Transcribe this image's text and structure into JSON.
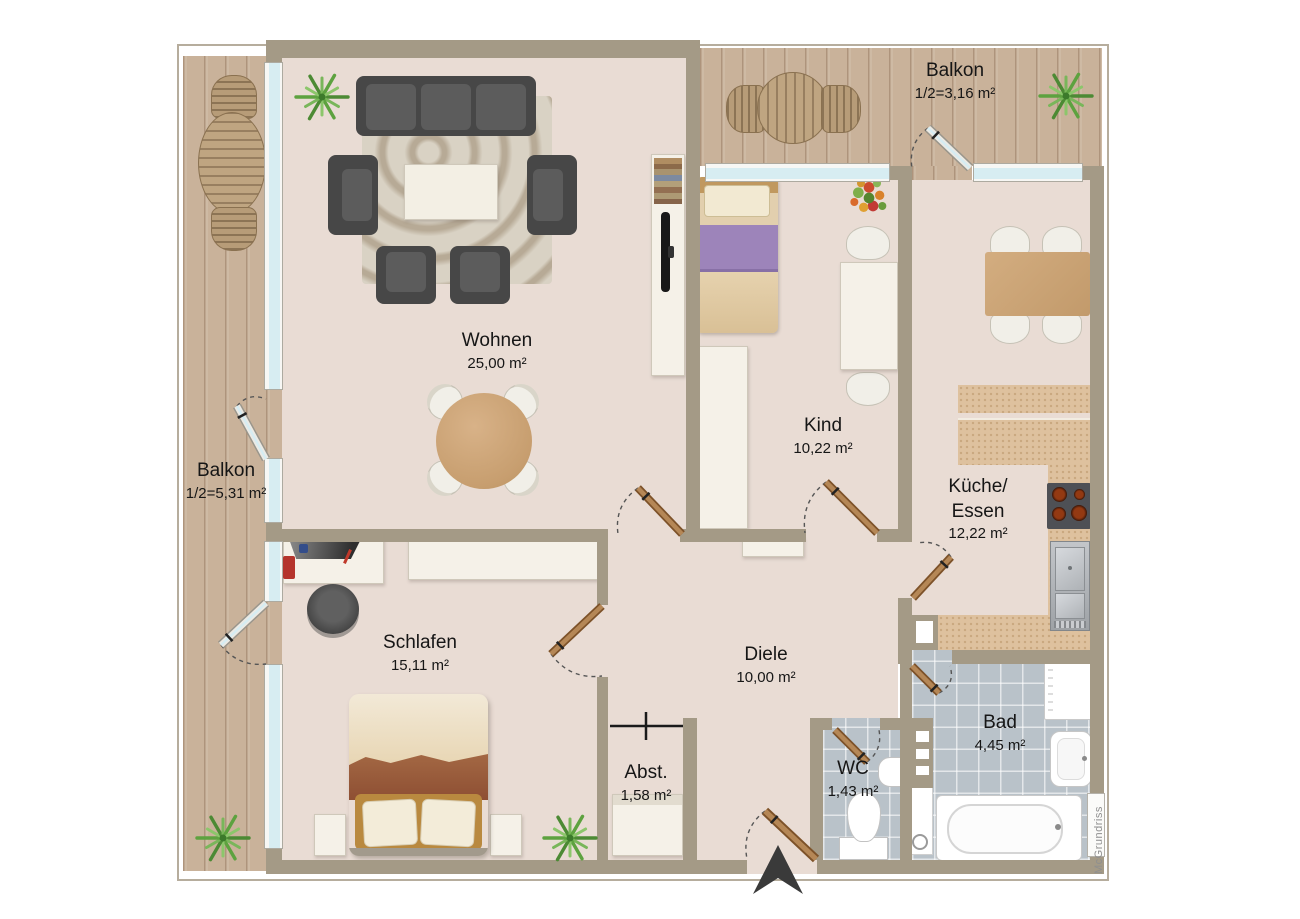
{
  "plan": {
    "watermark": "McGrundriss",
    "rooms": {
      "wohnen": {
        "name": "Wohnen",
        "area": "25,00 m²"
      },
      "kind": {
        "name": "Kind",
        "area": "10,22 m²"
      },
      "kueche": {
        "name_line1": "Küche/",
        "name_line2": "Essen",
        "area": "12,22 m²"
      },
      "schlafen": {
        "name": "Schlafen",
        "area": "15,11 m²"
      },
      "diele": {
        "name": "Diele",
        "area": "10,00 m²"
      },
      "abstellraum": {
        "name": "Abst.",
        "area": "1,58 m²"
      },
      "wc": {
        "name": "WC",
        "area": "1,43 m²"
      },
      "bad": {
        "name": "Bad",
        "area": "4,45 m²"
      },
      "balkon_top": {
        "name": "Balkon",
        "area": "1/2=3,16 m²"
      },
      "balkon_left": {
        "name": "Balkon",
        "area": "1/2=5,31 m²"
      }
    },
    "colors": {
      "wall": "#a49a86",
      "floor": "#e9dcd4",
      "balcony_wood": "#c9b29a",
      "tile": "#b9c2c9",
      "kitchen_counter": "#dec19e",
      "door_wood": "#9a6c3d",
      "window_glass": "#d7edf2",
      "plant_green": "#5a9a3f",
      "arrow": "#3a3a3a"
    }
  }
}
